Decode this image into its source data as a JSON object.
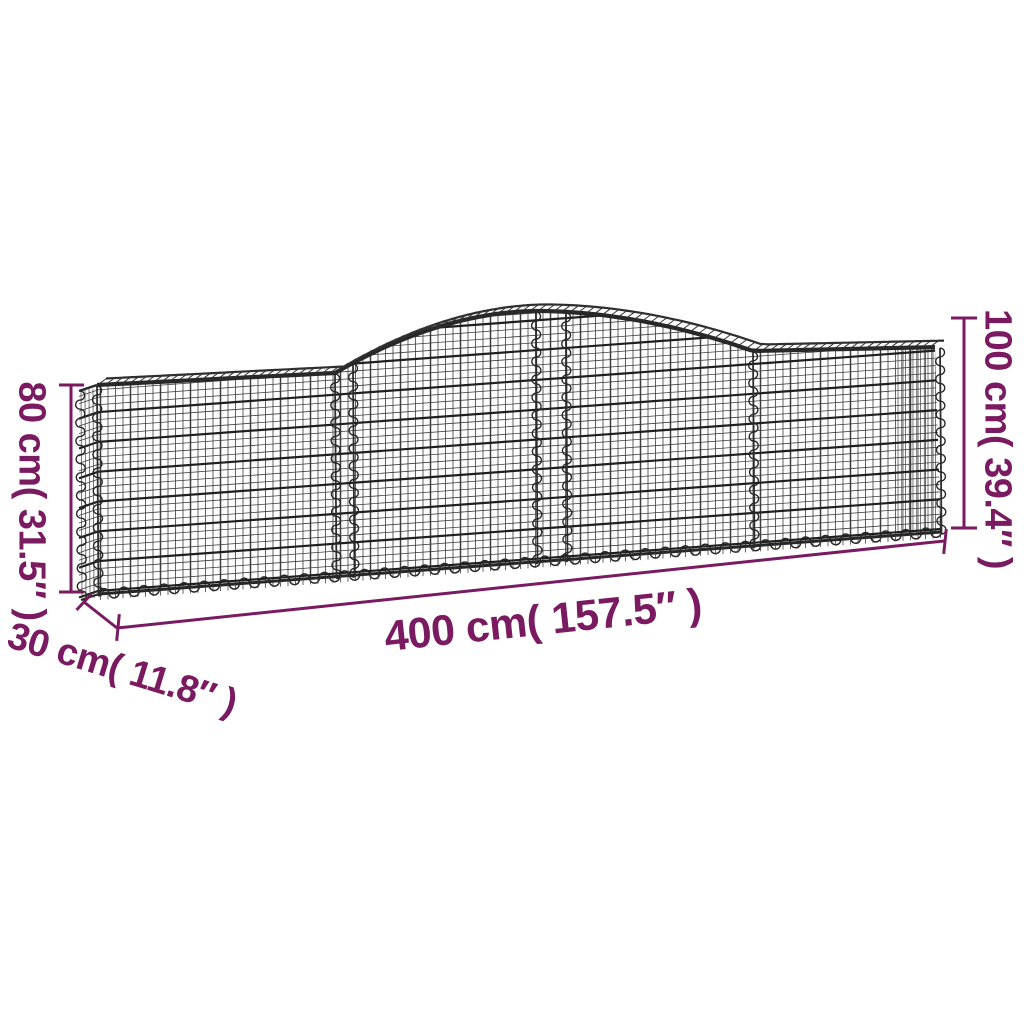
{
  "illustration": {
    "subject": "arched gabion wall basket, galvanized iron wire mesh, perspective line drawing"
  },
  "dimensions": {
    "height_left": "80 cm( 31.5″ )",
    "height_right": "100 cm( 39.4″ )",
    "length": "400 cm( 157.5″ )",
    "depth": "30 cm( 11.8″ )"
  },
  "colors": {
    "dimension_accent": "#7a1a60",
    "wire_thin": "#3d3d3d",
    "wire_thick": "#1f1f1f",
    "rim": "#282828",
    "background": "#ffffff"
  }
}
